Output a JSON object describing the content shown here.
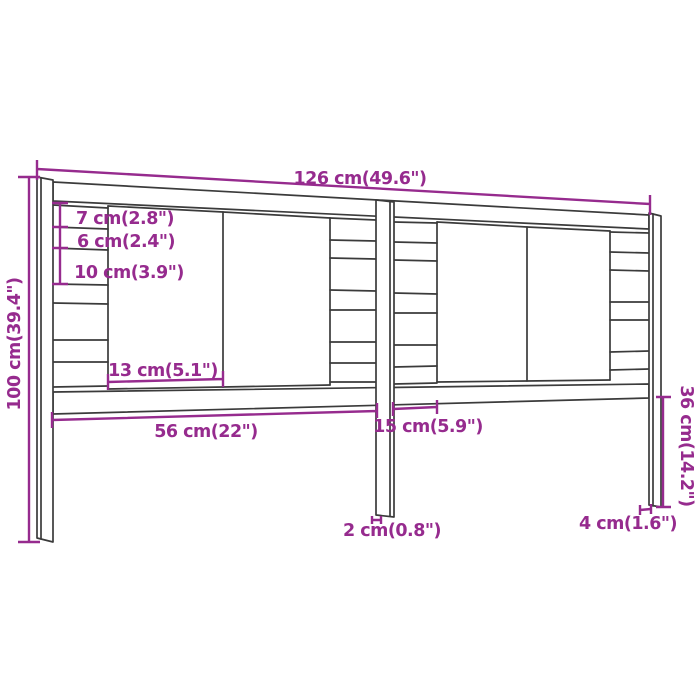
{
  "diagram": {
    "title": "Headboard dimension diagram",
    "colors": {
      "dimension": "#962B8E",
      "outline": "#3B3B3B",
      "background": "#FFFFFF"
    },
    "labels": {
      "overall_width": "126 cm(49.6\")",
      "overall_height": "100 cm(39.4\")",
      "slat_gap_top": "7 cm(2.8\")",
      "slat_gap_mid": "6 cm(2.4\")",
      "slat_gap_bottom": "10 cm(3.9\")",
      "panel_width": "13 cm(5.1\")",
      "lower_span_left": "56 cm(22\")",
      "lower_span_mid": "15 cm(5.9\")",
      "center_leg_thickness": "2 cm(0.8\")",
      "side_leg_thickness": "4 cm(1.6\")",
      "leg_height": "36 cm(14.2\")"
    }
  }
}
